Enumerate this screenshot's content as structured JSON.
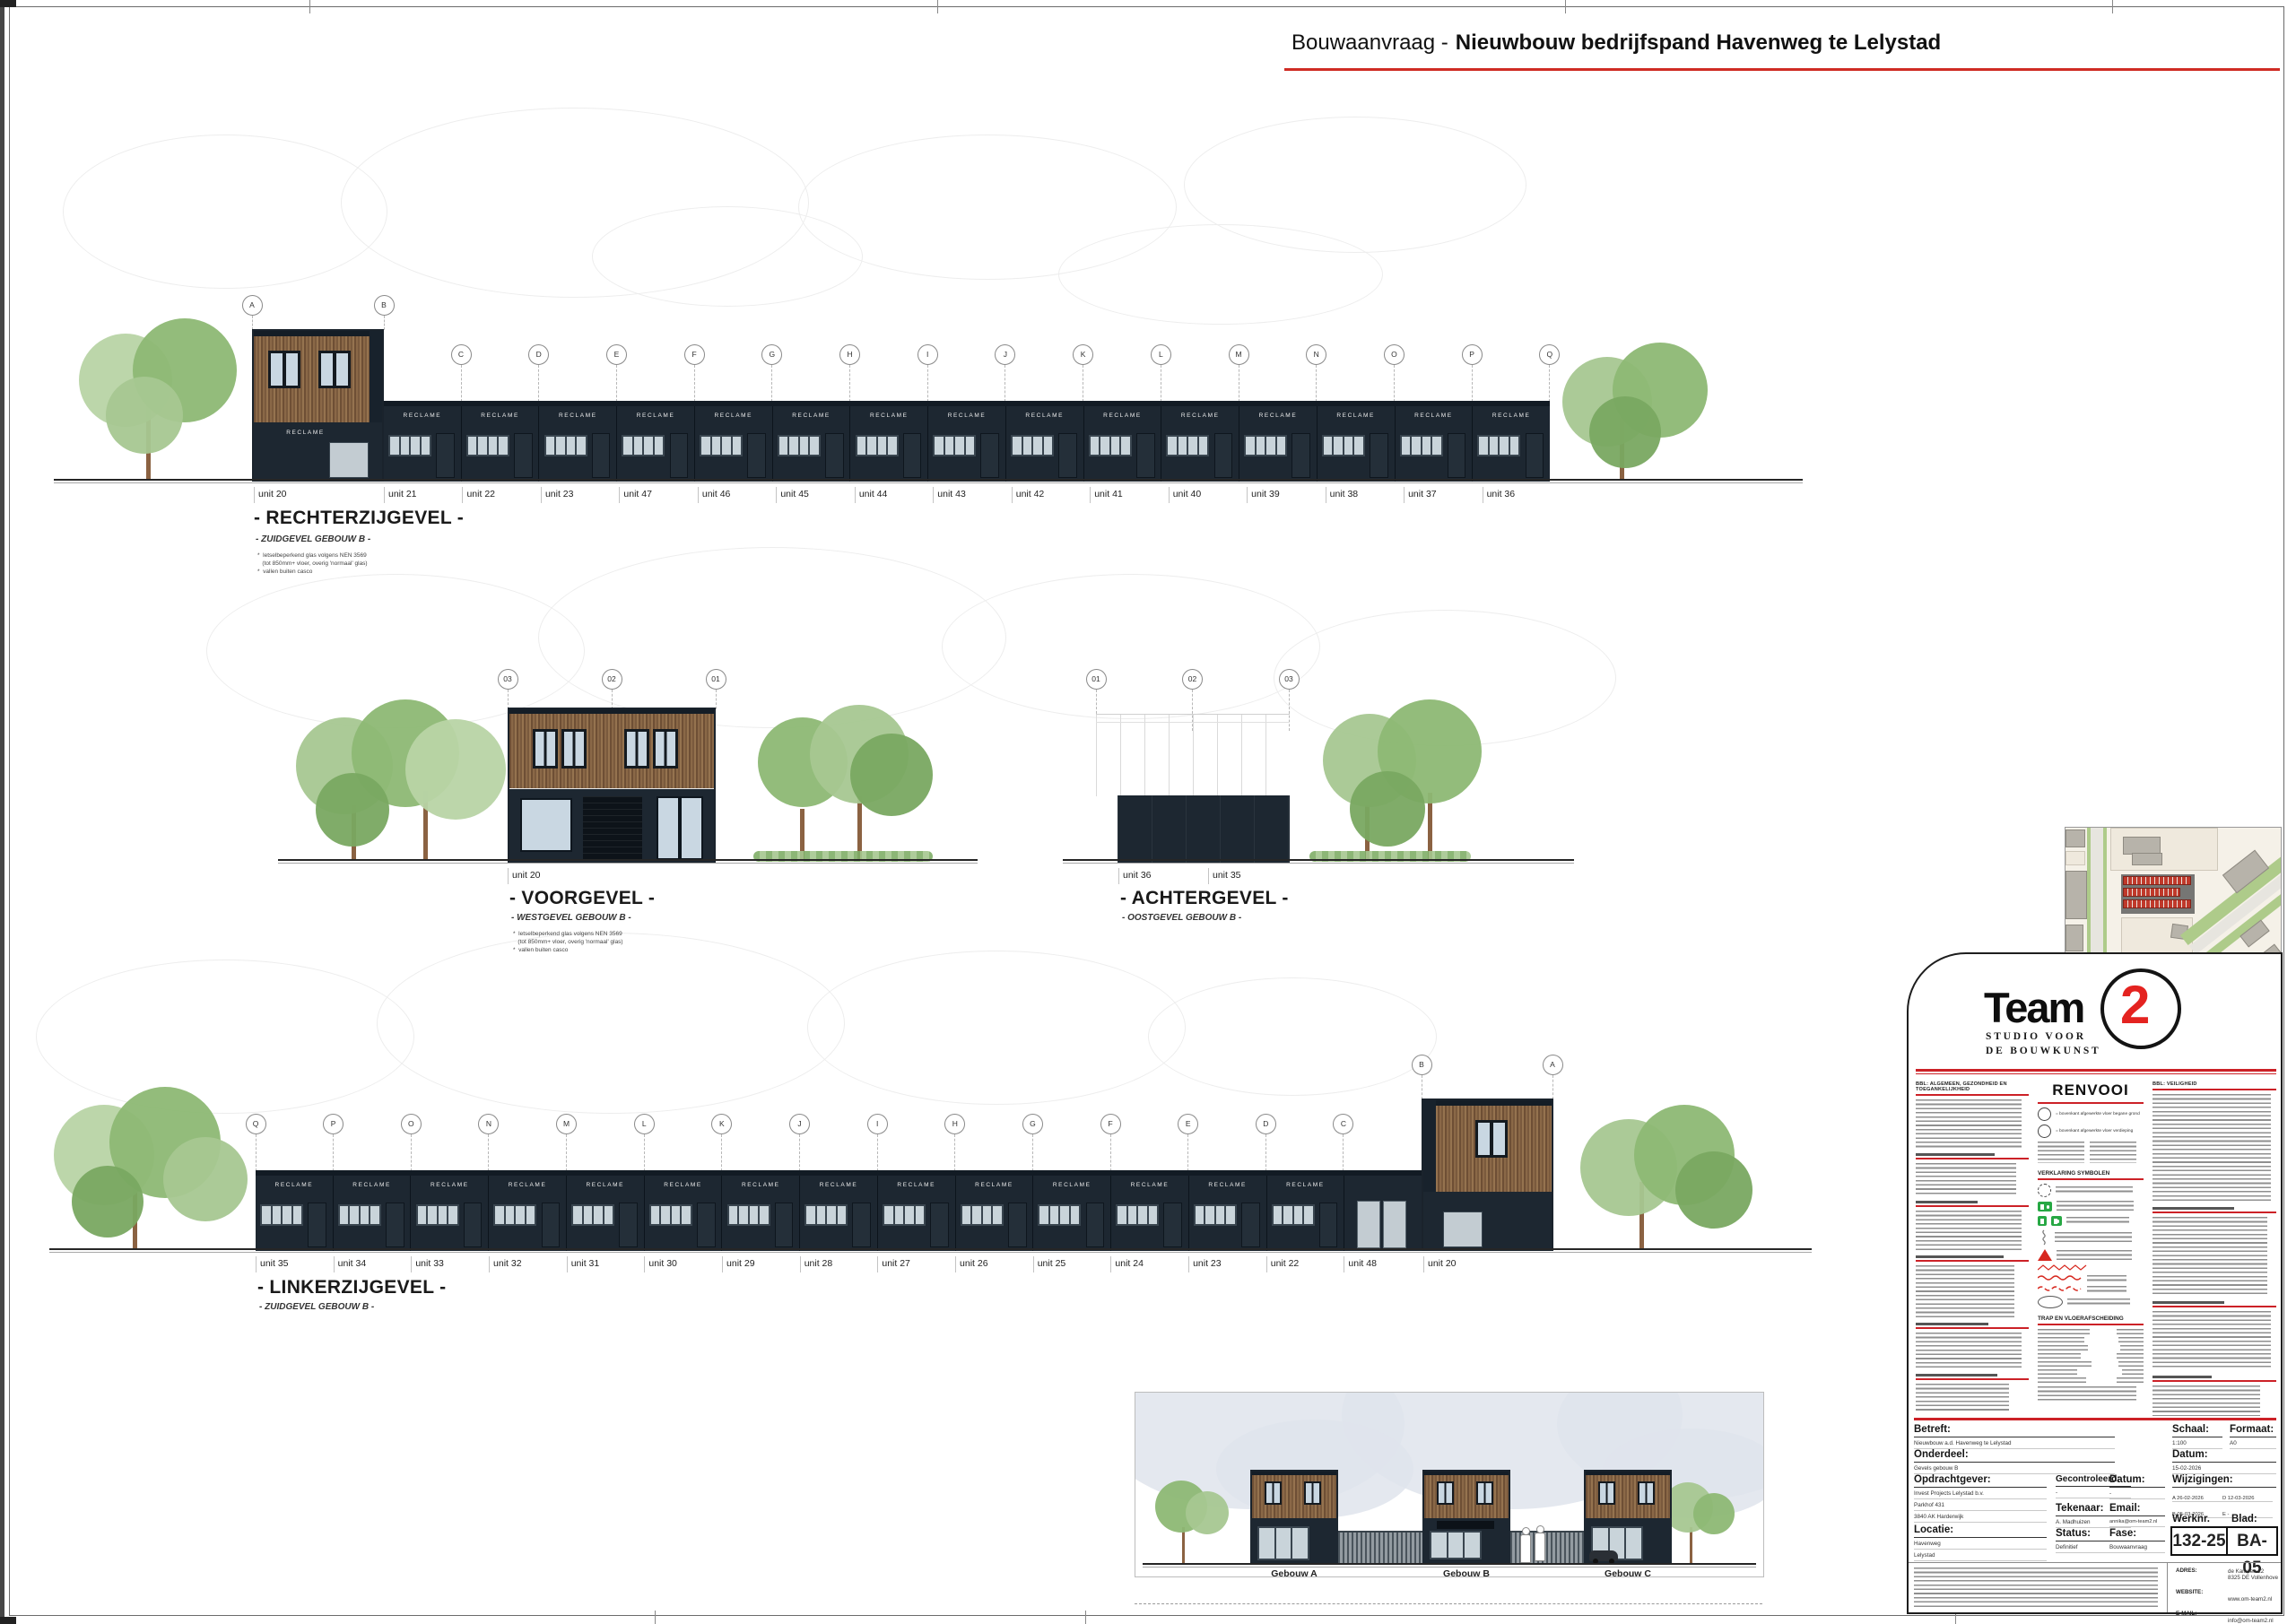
{
  "sheet": {
    "title_prefix": "Bouwaanvraag -",
    "title_main": "Nieuwbouw bedrijfspand Havenweg te Lelystad"
  },
  "elevations": {
    "rechter": {
      "title": "- RECHTERZIJGEVEL -",
      "subtitle": "- ZUIDGEVEL GEBOUW B -",
      "notes": [
        "*  letselbeperkend glas volgens NEN 3569",
        "   (tot 850mm+ vloer, overig 'normaal' glas)",
        "*  vallen buiten casco"
      ],
      "grid_high": [
        "A",
        "B"
      ],
      "grid_low": [
        "C",
        "D",
        "E",
        "F",
        "G",
        "H",
        "I",
        "J",
        "K",
        "L",
        "M",
        "N",
        "O",
        "P",
        "Q"
      ],
      "unit_head": "unit 20",
      "units": [
        "unit 21",
        "unit 22",
        "unit 23",
        "unit 47",
        "unit 46",
        "unit 45",
        "unit 44",
        "unit 43",
        "unit 42",
        "unit 41",
        "unit 40",
        "unit 39",
        "unit 38",
        "unit 37",
        "unit 36"
      ],
      "sign": "RECLAME"
    },
    "voor": {
      "title": "- VOORGEVEL -",
      "subtitle": "- WESTGEVEL GEBOUW B -",
      "notes": [
        "*  letselbeperkend glas volgens NEN 3569",
        "   (tot 850mm+ vloer, overig 'normaal' glas)",
        "*  vallen buiten casco"
      ],
      "grid": [
        "03",
        "02",
        "01"
      ],
      "unit": "unit 20"
    },
    "achter": {
      "title": "- ACHTERGEVEL -",
      "subtitle": "- OOSTGEVEL GEBOUW B -",
      "grid": [
        "01",
        "02",
        "03"
      ],
      "units": [
        "unit 36",
        "unit 35"
      ]
    },
    "linker": {
      "title": "- LINKERZIJGEVEL -",
      "subtitle": "- ZUIDGEVEL GEBOUW B -",
      "grid_low": [
        "Q",
        "P",
        "O",
        "N",
        "M",
        "L",
        "K",
        "J",
        "I",
        "H",
        "G",
        "F",
        "E",
        "D",
        "C"
      ],
      "grid_high": [
        "B",
        "A"
      ],
      "units": [
        "unit 35",
        "unit 34",
        "unit 33",
        "unit 32",
        "unit 31",
        "unit 30",
        "unit 29",
        "unit 28",
        "unit 27",
        "unit 26",
        "unit 25",
        "unit 24",
        "unit 23",
        "unit 22",
        "unit 48"
      ],
      "unit_head": "unit 20",
      "sign": "RECLAME"
    }
  },
  "overview": {
    "buildings": [
      "Gebouw A",
      "Gebouw B",
      "Gebouw C"
    ]
  },
  "titleblock": {
    "logo": {
      "word": "Team",
      "digit": "2",
      "tag1": "STUDIO VOOR",
      "tag2": "DE BOUWKUNST"
    },
    "legend": {
      "col1_heading": "BBL: ALGEMEEN, GEZONDHEID EN TOEGANKELIJKHEID",
      "renvooi": "RENVOOI",
      "peil_bg": "= bovenkant afgewerkte vloer begane grond",
      "peil_vd": "= bovenkant afgewerkte vloer verdieping",
      "symbols_heading": "VERKLARING SYMBOLEN",
      "trap_heading": "TRAP EN VLOERAFSCHEIDING",
      "col3_heading": "BBL: VEILIGHEID"
    },
    "form": {
      "betreft_label": "Betreft:",
      "betreft": "Nieuwbouw a.d. Havenweg te Lelystad",
      "onderdeel_label": "Onderdeel:",
      "onderdeel": "Gevels gebouw B",
      "opdrachtgever_label": "Opdrachtgever:",
      "opdrachtgever": [
        "Invest Projects Lelystad b.v.",
        "Parkhof 431",
        "3840 AK Harderwijk"
      ],
      "locatie_label": "Locatie:",
      "locatie": [
        "Havenweg",
        "Lelystad"
      ],
      "gecontroleerd_label": "Gecontroleerd:",
      "gecontroleerd": "-",
      "tekenaar_label": "Tekenaar:",
      "tekenaar": "A. Madhuizen",
      "status_label": "Status:",
      "status": "Definitief",
      "datum2_label": "Datum:",
      "datum2": "-",
      "email_label": "Email:",
      "email": "annika@om-team2.nl",
      "fase_label": "Fase:",
      "fase": "Bouwaanvraag",
      "schaal_label": "Schaal:",
      "schaal": "1:100",
      "formaat_label": "Formaat:",
      "formaat": "A0",
      "datum_label": "Datum:",
      "datum": "15-02-2026",
      "wijzigingen_label": "Wijzigingen:",
      "wijzigingen": [
        "A  26-02-2026",
        "B  05-03-2026",
        "C  10-03-2026",
        "D  12-03-2026",
        "E  -",
        "F  -"
      ],
      "werknr_label": "Werknr.",
      "werknr": "132-25",
      "blad_label": "Blad:",
      "blad": "BA-05"
    },
    "contact": {
      "adres_label": "ADRES:",
      "adres1": "de Kampen 22",
      "adres2": "8325 DE Vollenhove",
      "website_label": "WEBSITE:",
      "website": "www.om-team2.nl",
      "email_label": "E-MAIL:",
      "email": "info@om-team2.nl",
      "telefoon_label": "TELEFOON:",
      "telefoon": "0527-246743"
    }
  },
  "colors": {
    "accent_red": "#cf2b24",
    "facade_dark": "#1d2731",
    "wood": "#8a6847",
    "tree_green": "#8db874",
    "exit_green": "#27a844"
  }
}
